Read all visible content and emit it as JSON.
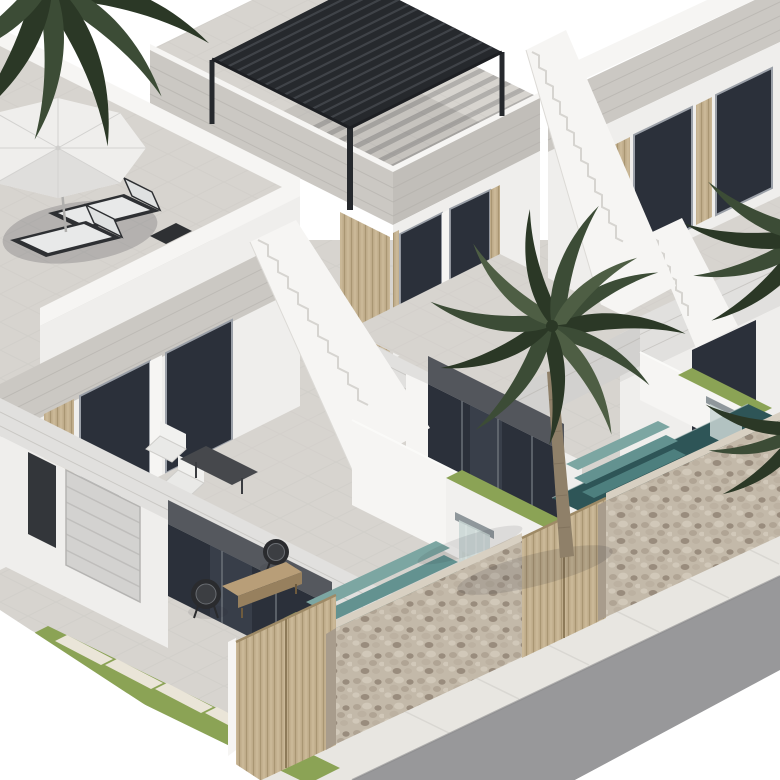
{
  "meta": {
    "type": "architectural-3d-render",
    "subject": "Row of modern two-storey white villas with rooftop terraces, pools, palm trees and a stone street wall",
    "view": "isometric aerial view",
    "visible_text": []
  },
  "palette": {
    "bg": "#ffffff",
    "wallWhite": "#f6f5f3",
    "wallLight": "#efeeec",
    "wallShade": "#e1e0de",
    "wallDark": "#d2d1cf",
    "fascia": "#cbc8c3",
    "fasciaDark": "#c1beb9",
    "fasciaLine": "#b3b0ab",
    "tile": "#d7d4cf",
    "tileLine": "#c3c0bb",
    "windowDark": "#2b303a",
    "windowMid": "#454c58",
    "windowFrame": "#9ba0a8",
    "doorDark": "#33363a",
    "garage": "#d3d2d0",
    "pergola": "#26292d",
    "pergolaLine": "#43464c",
    "wood": "#c4b190",
    "woodDark": "#9e8a66",
    "woodLight": "#d9c9a6",
    "stoneBase": "#c3b9a9",
    "stone1": "#b0a494",
    "stone2": "#d1c8b9",
    "stone3": "#998c7d",
    "stone4": "#bcb1a1",
    "poolDark": "#2e5557",
    "poolStep1": "#7ca6a2",
    "poolStep2": "#639290",
    "poolStep3": "#4d7f7e",
    "poolPale": "#c9d6d4",
    "grass": "#8ba355",
    "paver": "#eae5d8",
    "road": "#98989a",
    "sidewalk": "#e8e6e1",
    "sidewalkLine": "#d9d7d2",
    "palm": "#3c4c36",
    "palmDark": "#2b3826",
    "palmLight": "#4e5e44",
    "trunk": "#8f8069",
    "steel": "#8f979b"
  },
  "scene": {
    "left_villa": {
      "rooftop_terrace": {
        "umbrella": "white octagonal parasol",
        "sun_loungers": 2,
        "side_table": 1,
        "parapet": "white"
      },
      "first_floor": {
        "wood_slat_wall": 1,
        "glass_sliders": 2,
        "open_terrace_furniture": {
          "dark_table": 1,
          "white_chairs": 2
        }
      },
      "ground_floor": {
        "entrance_door": "dark",
        "garage_door": "light grey sectional",
        "glass_slider": "dark",
        "patio_chairs": 2,
        "coffee_table": "wood"
      },
      "external_staircase": "white with steps",
      "pool": {
        "color": "teal mosaic",
        "steps": 3,
        "waterfall": "wall spout"
      }
    },
    "middle_villa": {
      "rooftop_terrace": {
        "pergola": "black louvered aluminium, 3 visible posts",
        "louver_shadow": "striped"
      },
      "first_floor": {
        "glass_sliders": 2,
        "wood_slat_wall": 1,
        "balcony": "tiled"
      },
      "ground_floor": {
        "glass_slider": "dark"
      },
      "external_staircase": "white with steps",
      "pool": {
        "color": "teal mosaic",
        "steps": 3,
        "waterfall": "wall spout"
      }
    },
    "right_villa": {
      "visible": "partial, top-right corner",
      "first_floor": {
        "windows": 2,
        "wood_pillars": 2,
        "terrace": "tiled"
      },
      "external_staircase": "white wedge"
    },
    "site": {
      "stone_wall_segments": 2,
      "wooden_slat_gates": 2,
      "divider_walls": 2,
      "planter_grass_strips": 4,
      "grass_driveway_pavers": 5,
      "sidewalk": "white concrete with joints",
      "road": "grey asphalt, bottom-right corner",
      "palm_trees": {
        "full_center": 1,
        "top_left_fronds": 1,
        "right_edge_frond_clusters": 2
      }
    }
  }
}
